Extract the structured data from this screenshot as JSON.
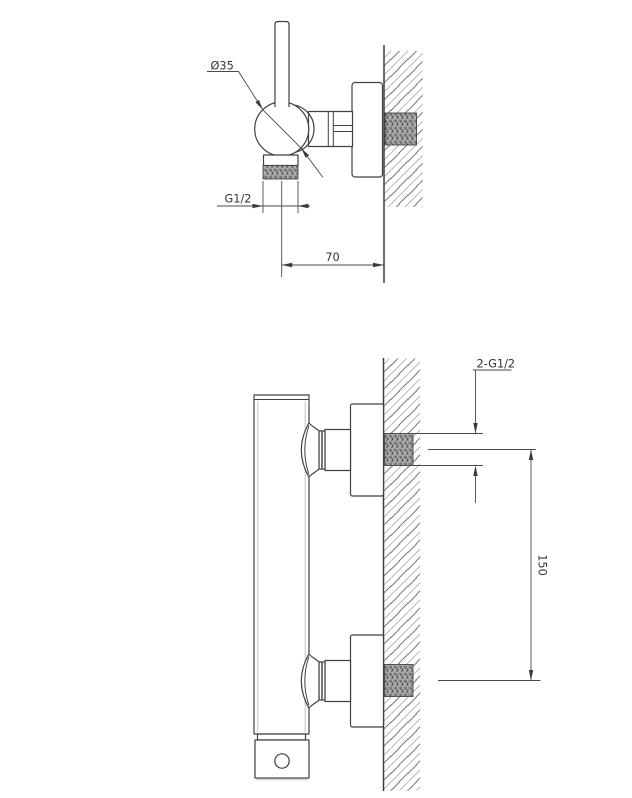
{
  "drawing": {
    "background_color": "#ffffff",
    "outline_color": "#414141",
    "dimension_color": "#3a3a3a",
    "side_view": {
      "handle_diameter": "Ø35",
      "outlet_thread": "G1/2",
      "wall_offset": "70"
    },
    "front_view": {
      "inlet_threads": "2-G1/2",
      "inlet_spacing": "150"
    }
  }
}
